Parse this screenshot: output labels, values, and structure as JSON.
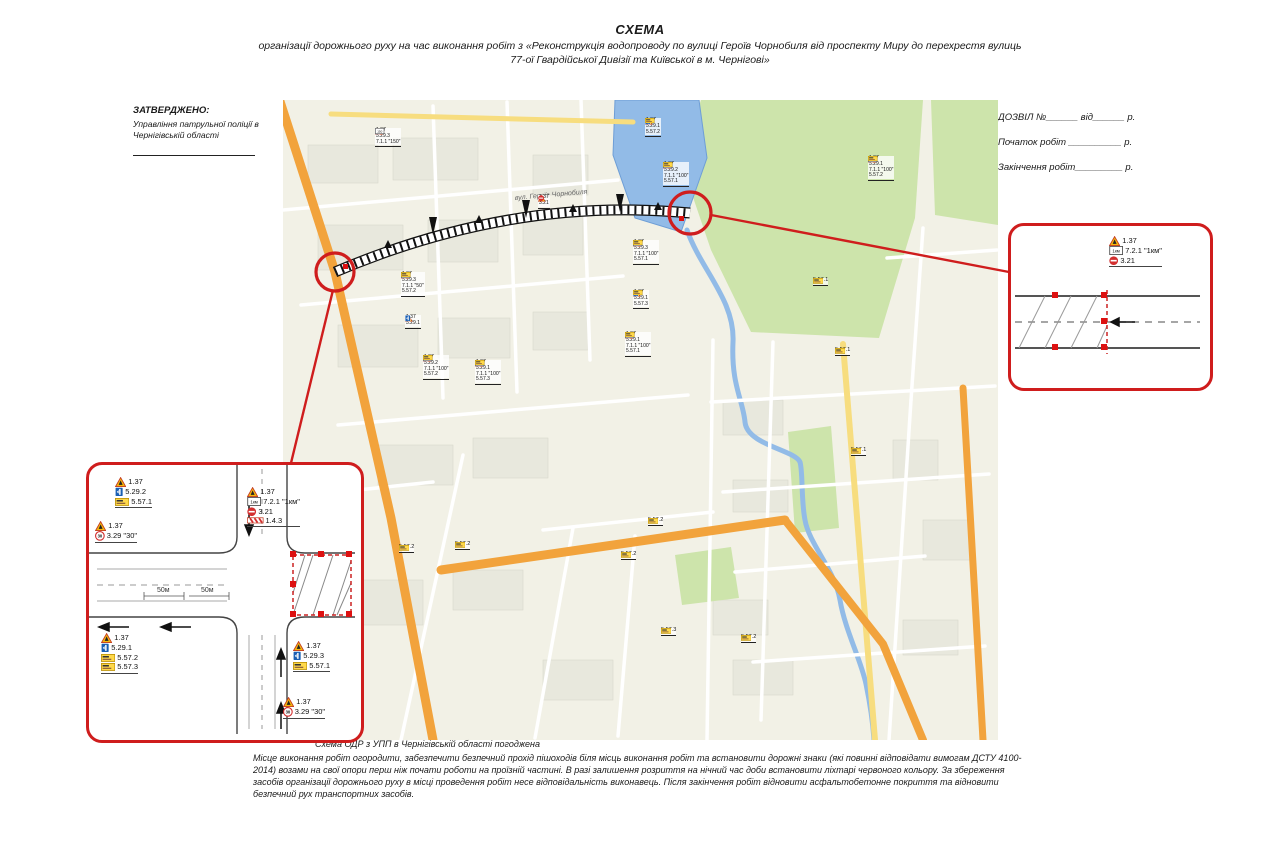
{
  "title": {
    "heading": "СХЕМА",
    "subtitle": "організації дорожнього руху на час виконання робіт з «Реконструкція водопроводу по вулиці Героїв Чорнобиля від проспекту Миру до перехрестя вулиць 77-ої Гвардійської Дивізії та Київської в м. Чернігові»"
  },
  "approved": {
    "heading": "ЗАТВЕРДЖЕНО:",
    "org": "Управління патрульної поліції в Чернігівській області"
  },
  "permit": {
    "line1": "ДОЗВІЛ №______ від______ р.",
    "line2": "Початок робіт __________ р.",
    "line3": "Закінчення робіт_________ р."
  },
  "map": {
    "street_label": "вул. Героїв Чорнобиля",
    "markers": [
      {
        "x": 92,
        "y": 28,
        "rows": [
          {
            "icon": "warn",
            "label": "1.37"
          },
          {
            "icon": "blue",
            "label": "5.29.3"
          },
          {
            "icon": "plate",
            "value": "150",
            "label": "7.1.1 \"150\""
          }
        ]
      },
      {
        "x": 362,
        "y": 18,
        "rows": [
          {
            "icon": "warn",
            "label": "1.37"
          },
          {
            "icon": "blue",
            "label": "5.29.1"
          },
          {
            "icon": "yellow",
            "label": "5.57.2"
          }
        ]
      },
      {
        "x": 380,
        "y": 62,
        "rows": [
          {
            "icon": "warn",
            "label": "1.37"
          },
          {
            "icon": "blue",
            "label": "5.29.2"
          },
          {
            "icon": "plate",
            "value": "100",
            "label": "7.1.1 \"100\""
          },
          {
            "icon": "yellow",
            "label": "5.57.1"
          }
        ]
      },
      {
        "x": 255,
        "y": 95,
        "rows": [
          {
            "icon": "warn",
            "label": "1.37"
          },
          {
            "icon": "noentry",
            "label": "3.21"
          }
        ]
      },
      {
        "x": 585,
        "y": 56,
        "rows": [
          {
            "icon": "warn",
            "label": "1.37"
          },
          {
            "icon": "blue",
            "label": "5.29.1"
          },
          {
            "icon": "plate",
            "value": "100",
            "label": "7.1.1 \"100\""
          },
          {
            "icon": "yellow",
            "label": "5.57.2"
          }
        ]
      },
      {
        "x": 350,
        "y": 140,
        "rows": [
          {
            "icon": "warn",
            "label": "1.37"
          },
          {
            "icon": "blue",
            "label": "5.29.3"
          },
          {
            "icon": "plate",
            "value": "100",
            "label": "7.1.1 \"100\""
          },
          {
            "icon": "yellow",
            "label": "5.57.1"
          }
        ]
      },
      {
        "x": 350,
        "y": 190,
        "rows": [
          {
            "icon": "warn",
            "label": "1.37"
          },
          {
            "icon": "blue",
            "label": "5.29.1"
          },
          {
            "icon": "yellow",
            "label": "5.57.3"
          }
        ]
      },
      {
        "x": 342,
        "y": 232,
        "rows": [
          {
            "icon": "warn",
            "label": "1.37"
          },
          {
            "icon": "blue",
            "label": "5.29.1"
          },
          {
            "icon": "plate",
            "value": "100",
            "label": "7.1.1 \"100\""
          },
          {
            "icon": "yellow",
            "label": "5.57.1"
          }
        ]
      },
      {
        "x": 118,
        "y": 172,
        "rows": [
          {
            "icon": "warn",
            "label": "1.37"
          },
          {
            "icon": "blue",
            "label": "5.29.3"
          },
          {
            "icon": "plate",
            "value": "50",
            "label": "7.1.1 \"50\""
          },
          {
            "icon": "yellow",
            "label": "5.57.2"
          }
        ]
      },
      {
        "x": 122,
        "y": 215,
        "rows": [
          {
            "icon": "warn",
            "label": "1.37"
          },
          {
            "icon": "blue",
            "label": "5.29.1"
          }
        ]
      },
      {
        "x": 140,
        "y": 255,
        "rows": [
          {
            "icon": "warn",
            "label": "1.37"
          },
          {
            "icon": "blue",
            "label": "5.29.2"
          },
          {
            "icon": "plate",
            "value": "100",
            "label": "7.1.1 \"100\""
          },
          {
            "icon": "yellow",
            "label": "5.57.2"
          }
        ]
      },
      {
        "x": 192,
        "y": 260,
        "rows": [
          {
            "icon": "warn",
            "label": "1.37"
          },
          {
            "icon": "blue",
            "label": "5.29.1"
          },
          {
            "icon": "plate",
            "value": "100",
            "label": "7.1.1 \"100\""
          },
          {
            "icon": "yellow",
            "label": "5.57.3"
          }
        ]
      }
    ],
    "plates": [
      {
        "x": 530,
        "y": 178,
        "label": "5.57.1"
      },
      {
        "x": 552,
        "y": 248,
        "label": "5.57.1"
      },
      {
        "x": 568,
        "y": 348,
        "label": "5.57.1"
      },
      {
        "x": 365,
        "y": 418,
        "label": "5.57.2"
      },
      {
        "x": 116,
        "y": 445,
        "label": "5.57.2"
      },
      {
        "x": 172,
        "y": 442,
        "label": "5.57.2"
      },
      {
        "x": 338,
        "y": 452,
        "label": "5.57.2"
      },
      {
        "x": 378,
        "y": 528,
        "label": "5.57.3"
      },
      {
        "x": 458,
        "y": 535,
        "label": "5.57.2"
      }
    ]
  },
  "inset_intersection": {
    "dims": [
      "50м",
      "50м"
    ],
    "groups": [
      {
        "x": 26,
        "y": 12,
        "rows": [
          {
            "icon": "warn",
            "label": "1.37"
          },
          {
            "icon": "blue",
            "label": "5.29.2"
          },
          {
            "icon": "yellow",
            "label": "5.57.1"
          }
        ]
      },
      {
        "x": 6,
        "y": 56,
        "rows": [
          {
            "icon": "warn",
            "label": "1.37"
          },
          {
            "icon": "speed",
            "value": "30",
            "label": "3.29 \"30\""
          }
        ]
      },
      {
        "x": 158,
        "y": 22,
        "rows": [
          {
            "icon": "warn",
            "label": "1.37"
          },
          {
            "icon": "plate",
            "value": "1км",
            "label": "7.2.1 \"1км\""
          },
          {
            "icon": "noentry",
            "label": "3.21"
          },
          {
            "icon": "stripe",
            "label": "1.4.3"
          }
        ]
      },
      {
        "x": 12,
        "y": 168,
        "rows": [
          {
            "icon": "warn",
            "label": "1.37"
          },
          {
            "icon": "blue",
            "label": "5.29.1"
          },
          {
            "icon": "yellow",
            "label": "5.57.2"
          },
          {
            "icon": "yellow",
            "label": "5.57.3"
          }
        ]
      },
      {
        "x": 204,
        "y": 176,
        "rows": [
          {
            "icon": "warn",
            "label": "1.37"
          },
          {
            "icon": "blue",
            "label": "5.29.3"
          },
          {
            "icon": "yellow",
            "label": "5.57.1"
          }
        ]
      },
      {
        "x": 194,
        "y": 232,
        "rows": [
          {
            "icon": "warn",
            "label": "1.37"
          },
          {
            "icon": "speed",
            "value": "30",
            "label": "3.29 \"30\""
          }
        ]
      }
    ]
  },
  "inset_road": {
    "groups": [
      {
        "x": 98,
        "y": 10,
        "rows": [
          {
            "icon": "warn",
            "label": "1.37"
          },
          {
            "icon": "plate",
            "value": "1км",
            "label": "7.2.1 \"1км\""
          },
          {
            "icon": "noentry",
            "label": "3.21"
          }
        ]
      }
    ]
  },
  "footer": {
    "approval": "Схема ОДР з УПП в Чернігівській області погоджена",
    "note": "Місце виконання робіт огородити, забезпечити безпечний прохід пішоходів біля місць виконання робіт та встановити дорожні знаки  (які повинні відповідати вимогам ДСТУ 4100-2014) возами на свої опори перш ніж почати роботи на проїзній частині. В разі залишення розриття на нічний час доби встановити ліхтарі червоного кольору. За збереження засобів організації дорожнього руху в місці проведення робіт несе відповідальність виконавець. Після закінчення робіт відновити асфальтобетонне покриття та відновити безпечний рух транспортних засобів."
  }
}
